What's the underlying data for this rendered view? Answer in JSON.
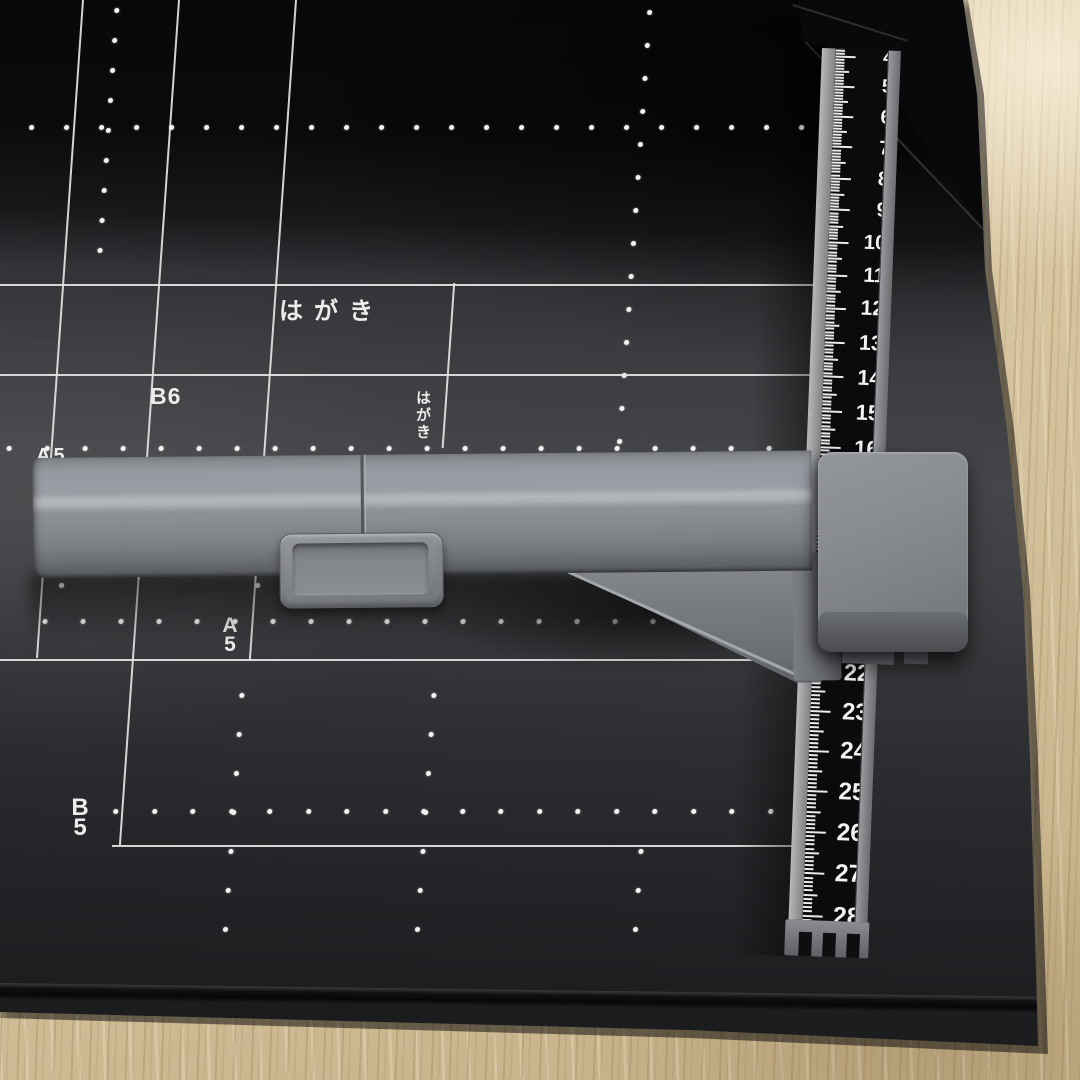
{
  "scene": {
    "description": "Black paper trimmer cutting board with white paper-size grid, gray sliding guide arm with handle, slider block and centimeter ruler, photographed on a light wood desk",
    "colors": {
      "board_black": "#1b1c1e",
      "grid_white": "#e8e8e8",
      "plastic_gray": "#85888d",
      "scale_black": "#0b0b0d",
      "wood": "#d8c7a4"
    }
  },
  "board": {
    "size_labels": [
      {
        "id": "hagaki-top",
        "text": "はがき",
        "orientation": "horizontal"
      },
      {
        "id": "b6",
        "text": "B6",
        "orientation": "horizontal"
      },
      {
        "id": "hagaki-mid",
        "text": "はがき",
        "orientation": "vertical"
      },
      {
        "id": "a5",
        "text": "A5",
        "orientation": "stacked"
      },
      {
        "id": "b5",
        "text": "B5",
        "orientation": "stacked"
      },
      {
        "id": "a5-partial",
        "text": "A5",
        "orientation": "horizontal",
        "note": "partially hidden behind guide arm"
      }
    ]
  },
  "ruler": {
    "numbers": [
      "4",
      "5",
      "6",
      "7",
      "8",
      "9",
      "10",
      "11",
      "12",
      "13",
      "14",
      "15",
      "16",
      "17",
      "18",
      "19",
      "20",
      "21",
      "22",
      "23",
      "24",
      "25",
      "26",
      "27",
      "28"
    ],
    "hidden_by_slider": [
      "17",
      "18",
      "19",
      "20",
      "21"
    ]
  }
}
